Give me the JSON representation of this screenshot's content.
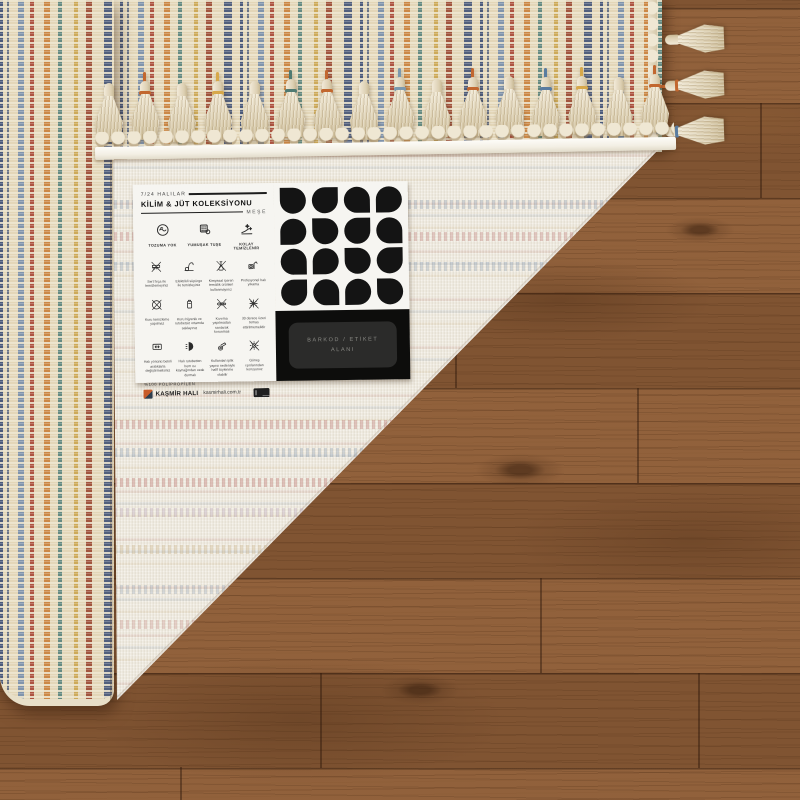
{
  "label": {
    "header": {
      "line1": "7/24 HALILAR",
      "title": "KİLİM & JÜT KOLEKSİYONU",
      "subtitle": "MEŞE"
    },
    "features": [
      {
        "icon": "no-shedding-icon",
        "caption": "TOZUMA YOK"
      },
      {
        "icon": "soft-touch-icon",
        "caption": "YUMUŞAK TUŞE"
      },
      {
        "icon": "easy-clean-icon",
        "caption": "KOLAY TEMİZLENİR"
      }
    ],
    "care_items": [
      {
        "icon": "no-hard-brush-icon",
        "caption": "Sert fırça ile temizlemeyiniz"
      },
      {
        "icon": "vacuum-icon",
        "caption": "Elektrikli süpürge ile temizleyiniz"
      },
      {
        "icon": "no-chemicals-icon",
        "caption": "Kimyasal içeren temizlik ürünleri kullanmayınız"
      },
      {
        "icon": "professional-clean-icon",
        "caption": "Profesyonel halı yıkama"
      },
      {
        "icon": "no-dry-clean-icon",
        "caption": "Kuru temizleme yapılmaz"
      },
      {
        "icon": "store-dry-icon",
        "caption": "Kuru hijyenik ve rutubetsiz ortamda saklayınız"
      },
      {
        "icon": "no-wring-icon",
        "caption": "Kıvırma yapılmadan sarılarak korunmalı"
      },
      {
        "icon": "no-hot-wash-icon",
        "caption": "30 derece üzeri temas ettirilmemelidir"
      },
      {
        "icon": "rotate-rug-icon",
        "caption": "Halı yönünü belirli aralıklarla değiştirmelisiniz"
      },
      {
        "icon": "keep-from-heat-icon",
        "caption": "Halı rutubetten hem ısı kaynağından uzak durmalı"
      },
      {
        "icon": "shedding-note-icon",
        "caption": "Kullanılan iplik yapısı nedeniyle hafif tüylenme olabilir"
      },
      {
        "icon": "no-sunlight-icon",
        "caption": "Güneş ışınlarından koruyunuz"
      }
    ],
    "material": "%100 POLİPROPİLEN",
    "brand": {
      "name": "KAŞMİR HALI",
      "website": "kasmirhali.com.tr",
      "logo_colors": {
        "orange": "#c75b28",
        "navy": "#2e3e4e"
      }
    },
    "barcode_area": {
      "line1": "BARKOD / ETİKET",
      "line2": "ALANI"
    },
    "colors": {
      "label_white": "#f6f5f1",
      "panel_black": "#0d0d0c",
      "motif_black": "#141414",
      "barcode_box": "#2b2b2a",
      "barcode_text": "#8a8a85"
    }
  },
  "rug": {
    "front_base": "#e3d6b8",
    "stripe_colors": [
      "#3e5076",
      "#6e88aa",
      "#a53c2c",
      "#c9803a",
      "#4e7d78",
      "#c9a24a",
      "#963e28"
    ],
    "back_base": "#ece7db",
    "binding_white": "#f7f4ec",
    "tassel_cream": "#e9dfc8",
    "fold_tassel_ties": [
      "none",
      "#c2672f",
      "none",
      "#d7a84a",
      "none",
      "#4f7a72",
      "#c2672f",
      "none",
      "#7b98ae",
      "none",
      "#c2672f",
      "none",
      "#5a7ca0",
      "#d7a84a",
      "none",
      "#c2672f"
    ],
    "side_tassel_ties": [
      "none",
      "#c2672f",
      "#5a7ca0"
    ]
  },
  "floor": {
    "wood_brown": "#8a5a36",
    "seam_dark": "#2e180a"
  }
}
